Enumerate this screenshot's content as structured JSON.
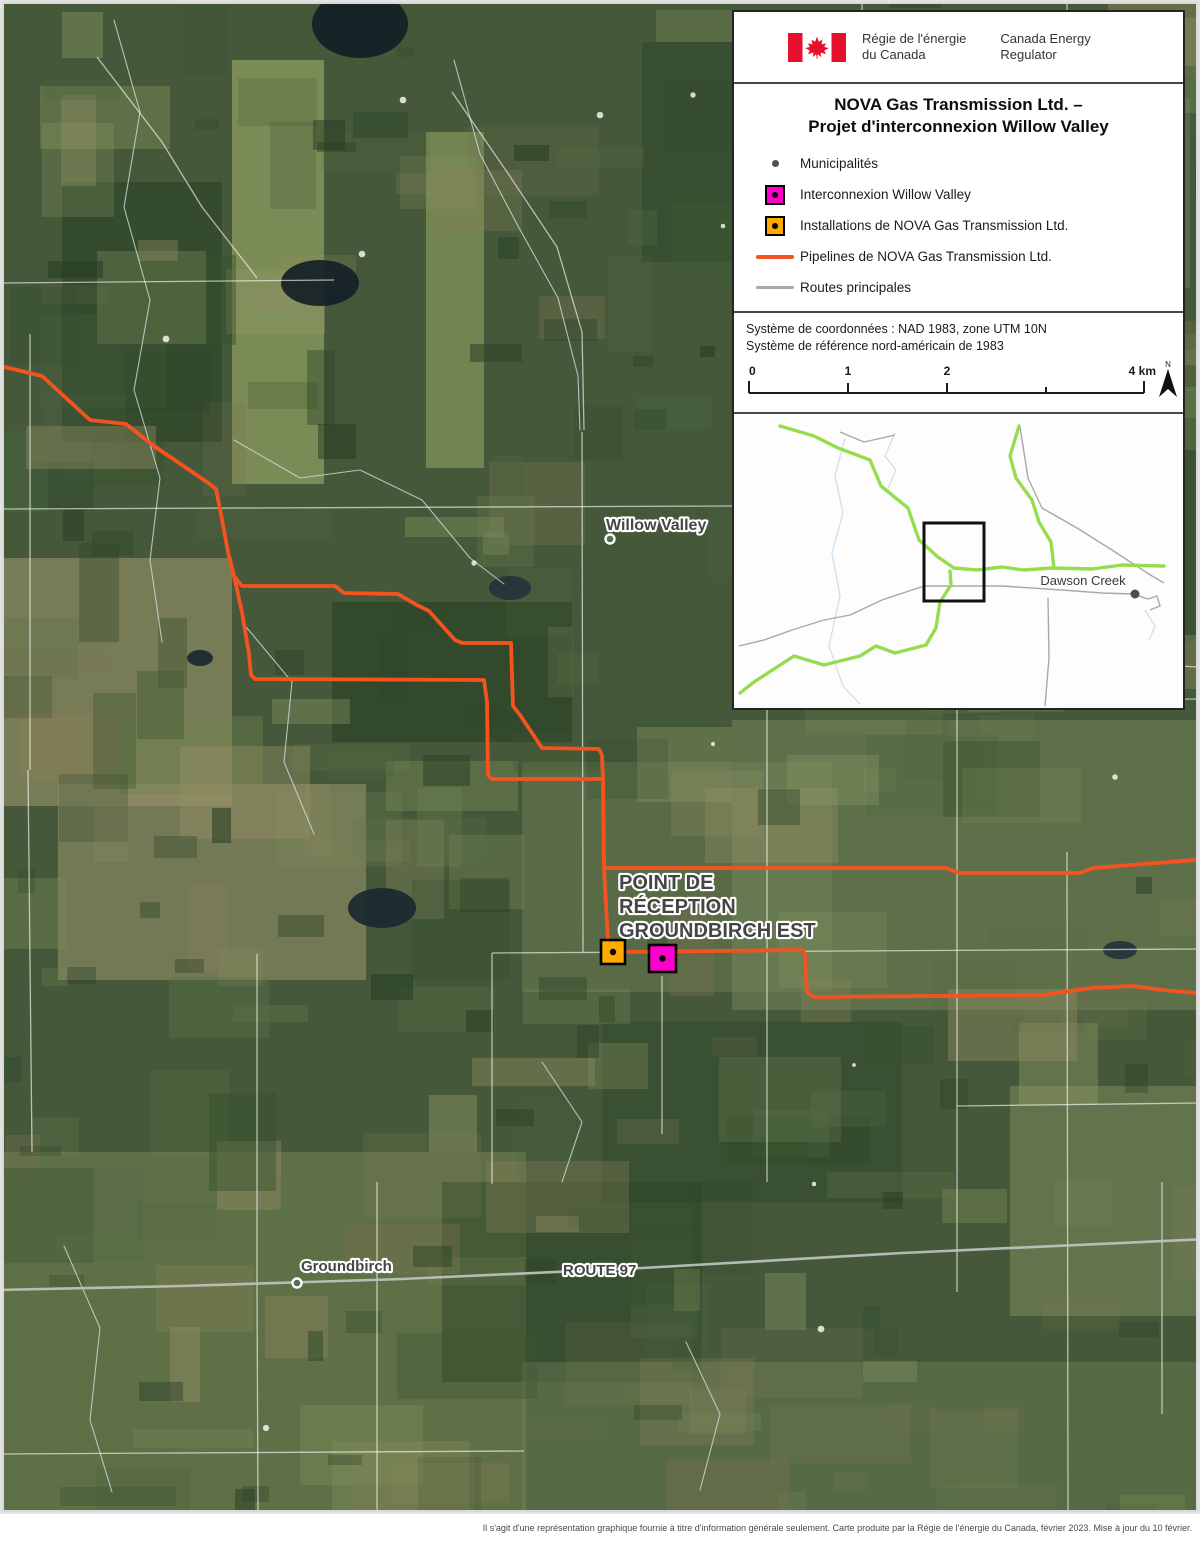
{
  "colors": {
    "pipeline": "#f4531f",
    "interconnection": "#ff00cc",
    "installation": "#ffaa00",
    "road": "#a9a9a9",
    "inset_pipeline": "#96dd4e",
    "inset_road": "#a8a8a8",
    "inset_water": "#c9dff0",
    "flag_red": "#e8112d"
  },
  "panel": {
    "logo": {
      "fr1": "Régie de l'énergie",
      "fr2": "du Canada",
      "en1": "Canada Energy",
      "en2": "Regulator"
    },
    "title_line1": "NOVA Gas Transmission Ltd. –",
    "title_line2": "Projet d'interconnexion Willow Valley",
    "legend": [
      {
        "label": "Municipalités"
      },
      {
        "label": "Interconnexion Willow Valley"
      },
      {
        "label": "Installations de NOVA Gas Transmission Ltd."
      },
      {
        "label": "Pipelines de NOVA Gas Transmission Ltd."
      },
      {
        "label": "Routes principales"
      }
    ],
    "coords_line1": "Système de coordonnées : NAD 1983, zone UTM 10N",
    "coords_line2": "Système de référence nord-américain de 1983",
    "scale": {
      "k0": "0",
      "k1": "1",
      "k2": "2",
      "k4": "4 km",
      "north": "N"
    },
    "inset": {
      "city": {
        "label": "Dawson Creek",
        "x": 1081,
        "y": 577,
        "dot": [
          1133,
          586
        ]
      },
      "extent_rect": [
        922,
        515,
        60,
        78
      ],
      "green": [
        [
          [
            778,
            418
          ],
          [
            812,
            428
          ],
          [
            836,
            440
          ],
          [
            868,
            452
          ],
          [
            879,
            478
          ],
          [
            906,
            500
          ],
          [
            917,
            532
          ],
          [
            936,
            549
          ],
          [
            952,
            560
          ],
          [
            975,
            562
          ],
          [
            1000,
            559
          ],
          [
            1022,
            562
          ],
          [
            1050,
            560
          ],
          [
            1090,
            561
          ],
          [
            1120,
            557
          ],
          [
            1162,
            558
          ]
        ],
        [
          [
            1017,
            418
          ],
          [
            1008,
            448
          ],
          [
            1014,
            470
          ],
          [
            1030,
            492
          ],
          [
            1037,
            514
          ],
          [
            1049,
            534
          ],
          [
            1052,
            560
          ]
        ],
        [
          [
            948,
            563
          ],
          [
            949,
            577
          ],
          [
            938,
            594
          ],
          [
            934,
            620
          ],
          [
            924,
            637
          ],
          [
            893,
            645
          ],
          [
            874,
            638
          ],
          [
            858,
            648
          ],
          [
            822,
            657
          ],
          [
            792,
            648
          ],
          [
            752,
            674
          ],
          [
            738,
            685
          ]
        ]
      ],
      "gray": [
        [
          [
            1018,
            419
          ],
          [
            1026,
            470
          ],
          [
            1040,
            500
          ],
          [
            1075,
            520
          ],
          [
            1110,
            542
          ],
          [
            1133,
            557
          ],
          [
            1150,
            568
          ],
          [
            1162,
            575
          ]
        ],
        [
          [
            737,
            638
          ],
          [
            762,
            632
          ],
          [
            790,
            622
          ],
          [
            822,
            612
          ],
          [
            848,
            607
          ],
          [
            880,
            592
          ],
          [
            922,
            578
          ],
          [
            1000,
            578
          ],
          [
            1060,
            582
          ],
          [
            1100,
            585
          ],
          [
            1131,
            586
          ],
          [
            1146,
            591
          ],
          [
            1155,
            588
          ],
          [
            1158,
            598
          ],
          [
            1148,
            602
          ]
        ],
        [
          [
            1046,
            590
          ],
          [
            1047,
            650
          ],
          [
            1043,
            698
          ]
        ],
        [
          [
            838,
            424
          ],
          [
            862,
            434
          ],
          [
            880,
            430
          ],
          [
            893,
            427
          ]
        ]
      ],
      "blue": [
        [
          [
            843,
            430
          ],
          [
            833,
            468
          ],
          [
            841,
            505
          ],
          [
            830,
            545
          ],
          [
            838,
            588
          ],
          [
            827,
            638
          ],
          [
            841,
            678
          ],
          [
            858,
            696
          ]
        ],
        [
          [
            893,
            425
          ],
          [
            883,
            448
          ],
          [
            894,
            462
          ],
          [
            886,
            480
          ]
        ],
        [
          [
            1143,
            602
          ],
          [
            1153,
            618
          ],
          [
            1147,
            632
          ]
        ]
      ]
    }
  },
  "map": {
    "pipelines": [
      [
        [
          -6,
          363
        ],
        [
          40,
          374
        ],
        [
          88,
          418
        ],
        [
          124,
          422
        ],
        [
          152,
          444
        ],
        [
          205,
          480
        ],
        [
          214,
          487
        ],
        [
          219,
          512
        ],
        [
          226,
          550
        ],
        [
          232,
          574
        ],
        [
          240,
          584
        ],
        [
          333,
          584
        ],
        [
          342,
          591
        ],
        [
          396,
          592
        ],
        [
          413,
          602
        ],
        [
          427,
          609
        ],
        [
          453,
          638
        ],
        [
          460,
          641
        ],
        [
          509,
          641
        ],
        [
          511,
          704
        ],
        [
          518,
          713
        ],
        [
          540,
          746
        ],
        [
          597,
          747
        ],
        [
          600,
          753
        ],
        [
          601,
          775
        ],
        [
          602,
          866
        ],
        [
          606,
          940
        ]
      ],
      [
        [
          232,
          574
        ],
        [
          240,
          610
        ],
        [
          247,
          652
        ],
        [
          249,
          673
        ],
        [
          253,
          677
        ],
        [
          482,
          678
        ],
        [
          485,
          700
        ],
        [
          486,
          773
        ],
        [
          490,
          777
        ],
        [
          598,
          777
        ]
      ],
      [
        [
          602,
          866
        ],
        [
          944,
          866
        ],
        [
          957,
          871
        ],
        [
          1078,
          871
        ],
        [
          1091,
          866
        ],
        [
          1206,
          857
        ]
      ],
      [
        [
          622,
          950
        ],
        [
          800,
          948
        ],
        [
          803,
          952
        ],
        [
          805,
          990
        ],
        [
          812,
          995
        ],
        [
          1040,
          993
        ],
        [
          1090,
          986
        ],
        [
          1130,
          984
        ],
        [
          1160,
          988
        ],
        [
          1206,
          992
        ]
      ]
    ],
    "route97_road": [
      [
        -6,
        1288
      ],
      [
        180,
        1284
      ],
      [
        400,
        1277
      ],
      [
        640,
        1266
      ],
      [
        900,
        1251
      ],
      [
        1206,
        1237
      ]
    ],
    "markers": [
      {
        "name": "installation-marker",
        "x": 599,
        "y": 938,
        "size": 24,
        "color": "#ffaa00"
      },
      {
        "name": "interconnection-marker",
        "x": 647,
        "y": 943,
        "size": 27,
        "color": "#ff00cc"
      }
    ],
    "labels": [
      {
        "text": "Willow Valley",
        "x": 604,
        "y": 528,
        "size": 16
      },
      {
        "text": "POINT DE",
        "x": 617,
        "y": 887,
        "size": 20
      },
      {
        "text": "RÉCEPTION",
        "x": 617,
        "y": 911,
        "size": 20
      },
      {
        "text": "GROUNDBIRCH EST",
        "x": 617,
        "y": 935,
        "size": 20
      },
      {
        "text": "Groundbirch",
        "x": 299,
        "y": 1269,
        "size": 15
      },
      {
        "text": "ROUTE 97",
        "x": 561,
        "y": 1273,
        "size": 15
      }
    ],
    "municipality_dots": [
      [
        608,
        537
      ],
      [
        295,
        1281
      ]
    ]
  },
  "footer": "Il s'agit d'une représentation graphique fournie à titre d'information générale seulement. Carte produite par la Régie de l'énergie du Canada, février 2023. Mise à jour du 10 février."
}
